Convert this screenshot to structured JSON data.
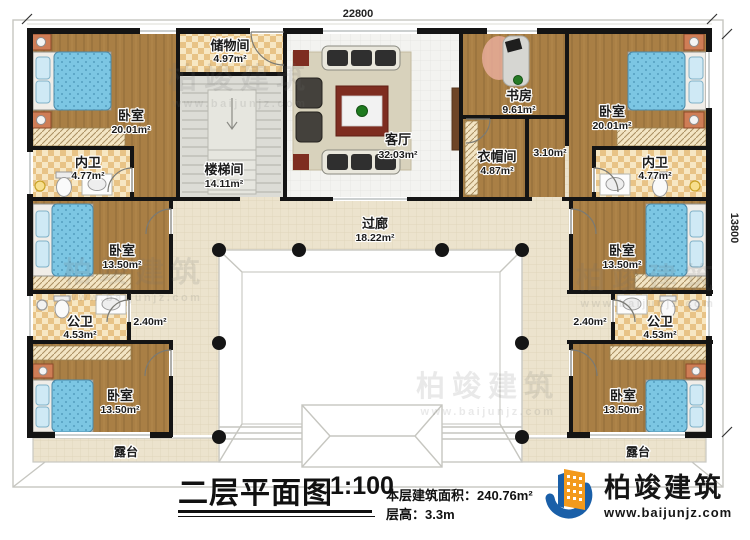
{
  "dimensions": {
    "top": "22800",
    "right": "13800"
  },
  "rooms": {
    "bedroom_tl": {
      "name": "卧室",
      "area": "20.01m²"
    },
    "bath_tl": {
      "name": "内卫",
      "area": "4.77m²"
    },
    "storage": {
      "name": "储物间",
      "area": "4.97m²"
    },
    "stairs": {
      "name": "楼梯间",
      "area": "14.11m²"
    },
    "living": {
      "name": "客厅",
      "area": "32.03m²"
    },
    "study": {
      "name": "书房",
      "area": "9.61m²"
    },
    "bedroom_tr": {
      "name": "卧室",
      "area": "20.01m²"
    },
    "closet": {
      "name": "衣帽间",
      "area": "4.87m²"
    },
    "bath_tr": {
      "name": "内卫",
      "area": "4.77m²"
    },
    "corridor": {
      "name": "过廊",
      "area": "18.22m²"
    },
    "bedroom_ml": {
      "name": "卧室",
      "area": "13.50m²"
    },
    "bath_ml": {
      "name": "公卫",
      "area": "4.53m²"
    },
    "bedroom_mr": {
      "name": "卧室",
      "area": "13.50m²"
    },
    "bath_mr": {
      "name": "公卫",
      "area": "4.53m²"
    },
    "bedroom_bl": {
      "name": "卧室",
      "area": "13.50m²"
    },
    "bedroom_br": {
      "name": "卧室",
      "area": "13.50m²"
    },
    "terrace_l": {
      "name": "露台"
    },
    "terrace_r": {
      "name": "露台"
    }
  },
  "halls": {
    "h310": "3.10m²",
    "h240l": "2.40m²",
    "h240r": "2.40m²"
  },
  "titleblock": {
    "title": "二层平面图",
    "scale": "1:100",
    "area_label": "本层建筑面积：",
    "area_value": "240.76m²",
    "height_label": "层高：",
    "height_value": "3.3m"
  },
  "brand": {
    "name": "柏竣建筑",
    "url": "www.baijunjz.com"
  },
  "watermark": {
    "text": "柏竣建筑",
    "url": "www.baijunjz.com"
  },
  "colors": {
    "wall": "#141414",
    "wood_floor": "#a97f45",
    "bath_checker": "#e8c386",
    "corridor_tile": "#ece3cd",
    "bed_blue": "#7cc6e3",
    "brand_blue": "#1a5fa8",
    "brand_orange": "#f39a1c"
  }
}
